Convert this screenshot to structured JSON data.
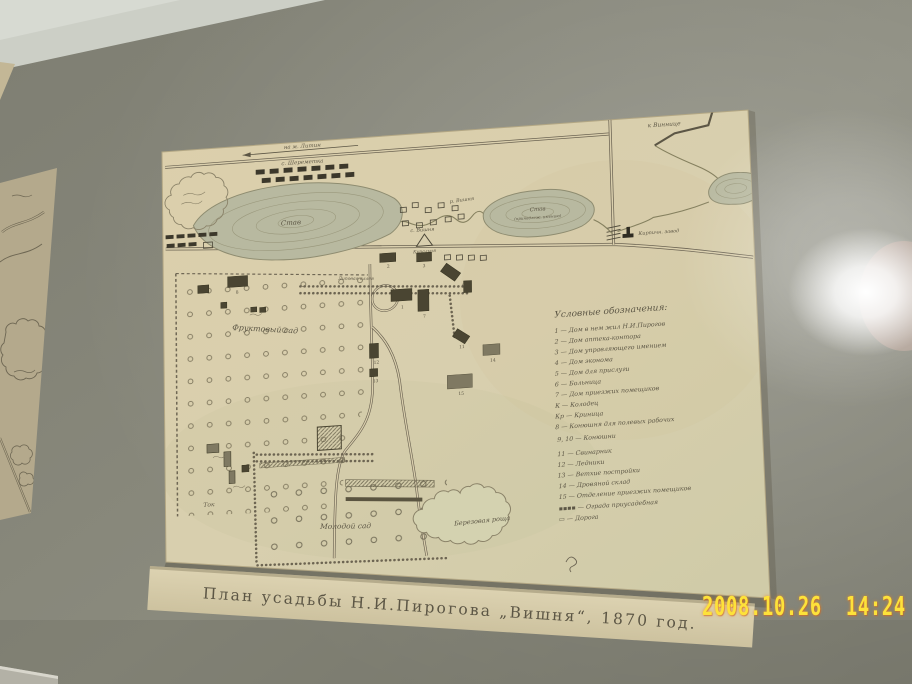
{
  "photo": {
    "timestamp": "2008.10.26  14:24",
    "caption": "План усадьбы Н.И.Пирогова „Вишня“, 1870 год."
  },
  "colors": {
    "wall": "#85857a",
    "paper": "#d9cfae",
    "caption_strip": "#d8cdab",
    "timestamp": "#fde23a",
    "ink": "#5c5645"
  },
  "map": {
    "labels": {
      "to_litin": "на м. Литин",
      "sheremetka": "с. Шереметка",
      "pond_big": "Став",
      "kupalnya": "Купальня",
      "river": "р. Вишня",
      "vishnya": "с. Вишня",
      "pond2_l1": "Став",
      "pond2_l2": "(принадлеж. имению)",
      "to_vinnitsa": "к Виннице",
      "brick_factory": "Кирпичн. завод",
      "fruit_orchard": "Фруктовый сад",
      "alley": "Липовая аллея",
      "young_orchard": "Молодой сад",
      "tok": "Ток",
      "birch_grove": "Березовая роща"
    },
    "building_numbers": [
      "1",
      "2",
      "3",
      "6",
      "7",
      "8",
      "11",
      "12",
      "13",
      "14",
      "15"
    ],
    "legend": {
      "title": "Условные обозначения:",
      "items": [
        "1 — Дом в нем жил Н.И.Пирогов",
        "2 — Дом аптека-контора",
        "3 — Дом управляющего имением",
        "4 — Дом эконома",
        "5 — Дом для прислуги",
        "6 — Больница",
        "7 — Дом приезжих помещиков",
        "К — Колодец",
        "Кр — Криница",
        "8 — Конюшня для полевых рабочих",
        "9, 10 — Конюшни",
        "11 — Свинарник",
        "12 — Ледники",
        "13 — Ветхие постройки",
        "14 — Дровяной склад",
        "15 — Отделение приезжих помещиков",
        "▪▪▪▪ — Ограда приусадебная",
        "▭ — Дорога"
      ]
    }
  }
}
